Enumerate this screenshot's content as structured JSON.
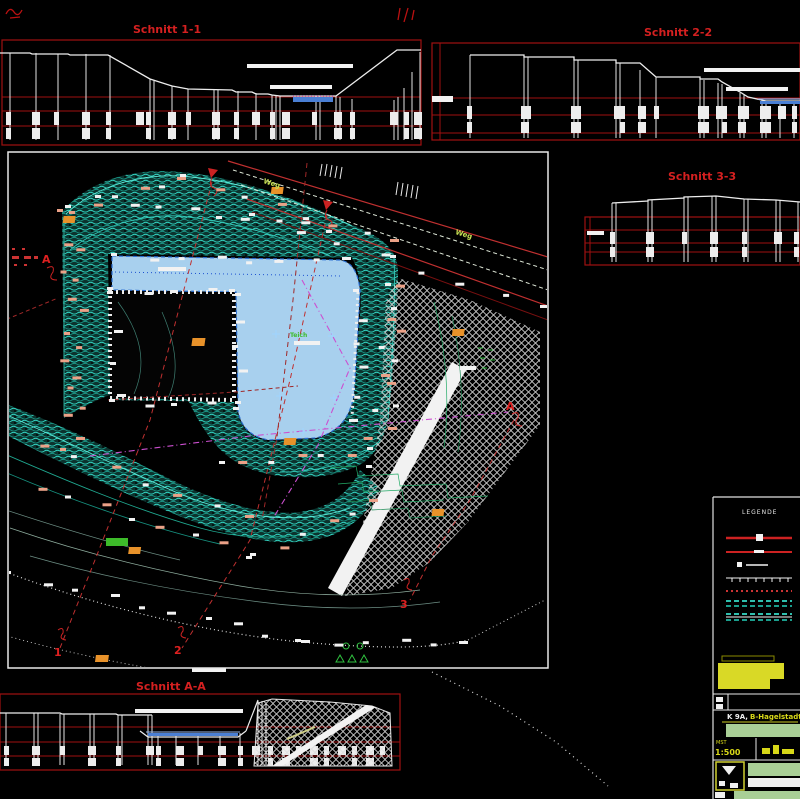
{
  "sections": {
    "s11": {
      "title": "Schnitt 1-1"
    },
    "s22": {
      "title": "Schnitt 2-2"
    },
    "s33": {
      "title": "Schnitt 3-3"
    },
    "saa": {
      "title": "Schnitt A-A"
    }
  },
  "plan": {
    "road_label_1": "Weg",
    "road_label_2": "Weg",
    "pond_label": "Teich",
    "markers": {
      "m1": "1",
      "m2": "2",
      "m3": "3",
      "a_left": "A",
      "a_right": "A"
    }
  },
  "legend": {
    "title": "LEGENDE"
  },
  "title_block": {
    "line1_white": "K 9A,",
    "line1_yellow": "B-Hagelstadt",
    "scale_label": "MST",
    "scale_value": "1:500"
  },
  "colors": {
    "background": "#000000",
    "frame_red": "#a01010",
    "title_red": "#d42020",
    "profile_white": "#ededed",
    "contour_teal": "#34d9c6",
    "contour_green": "#22aa66",
    "water_fill": "#a8d0ee",
    "water_line": "#4a7fd4",
    "hatch_white": "#dddddd",
    "marker_orange": "#e8922a",
    "tick_salmon": "#eba187",
    "road_label_green": "#c6e053",
    "boundary_magenta": "#cc4fd0",
    "titleblock_yellow": "#d8d818",
    "titleblock_green": "#a9cf96"
  }
}
